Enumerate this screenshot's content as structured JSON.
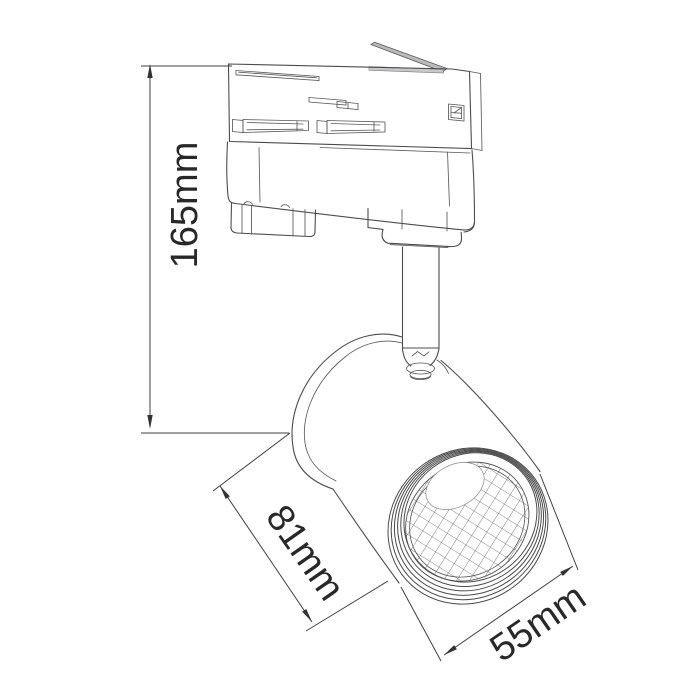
{
  "drawing": {
    "type": "technical-dimension-drawing",
    "subject": "track-light-spotlight",
    "background": "#ffffff"
  },
  "dimensions": {
    "height": {
      "label": "165mm",
      "value": 165,
      "unit": "mm"
    },
    "body_length": {
      "label": "81mm",
      "value": 81,
      "unit": "mm"
    },
    "head_diameter": {
      "label": "55mm",
      "value": 55,
      "unit": "mm"
    }
  },
  "colors": {
    "line": "#4c4c4c",
    "text": "#282828",
    "lever_fill": "#b9bbbd",
    "slot_fill": "#c6c8ca"
  }
}
